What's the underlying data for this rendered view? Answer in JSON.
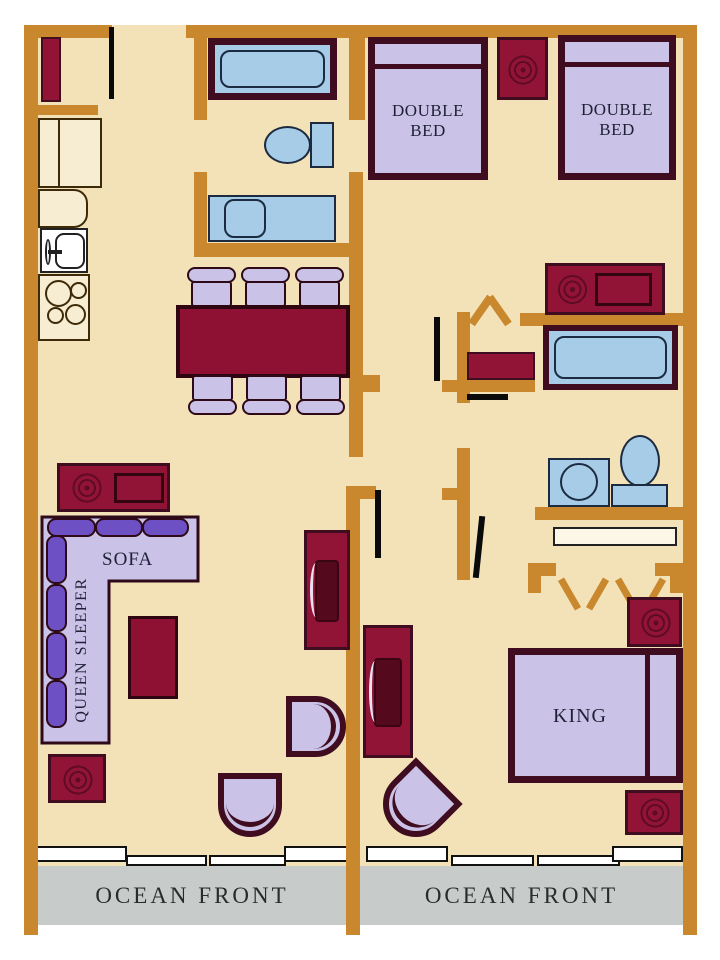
{
  "labels": {
    "bed1": "DOUBLE BED",
    "bed2": "DOUBLE BED",
    "king": "KING",
    "sofa": "SOFA",
    "queen_sleeper": "QUEEN SLEEPER",
    "balcony_left": "OCEAN FRONT",
    "balcony_right": "OCEAN FRONT"
  },
  "colors": {
    "background": "#FFFFFF",
    "floor": "#F3E2B8",
    "wall": "#C9872E",
    "dark_red": "#911335",
    "dark_red_inner": "#54091D",
    "maroon": "#3F0D1F",
    "lavender": "#CBC2E7",
    "purple": "#6C50C4",
    "light_blue": "#A6CCE8",
    "navy": "#1C2B40",
    "appliance_cream": "#F7EDD2",
    "balcony_gray": "#C7CCCB",
    "door_black": "#0A0A0A",
    "label_text": "#1E2136"
  }
}
